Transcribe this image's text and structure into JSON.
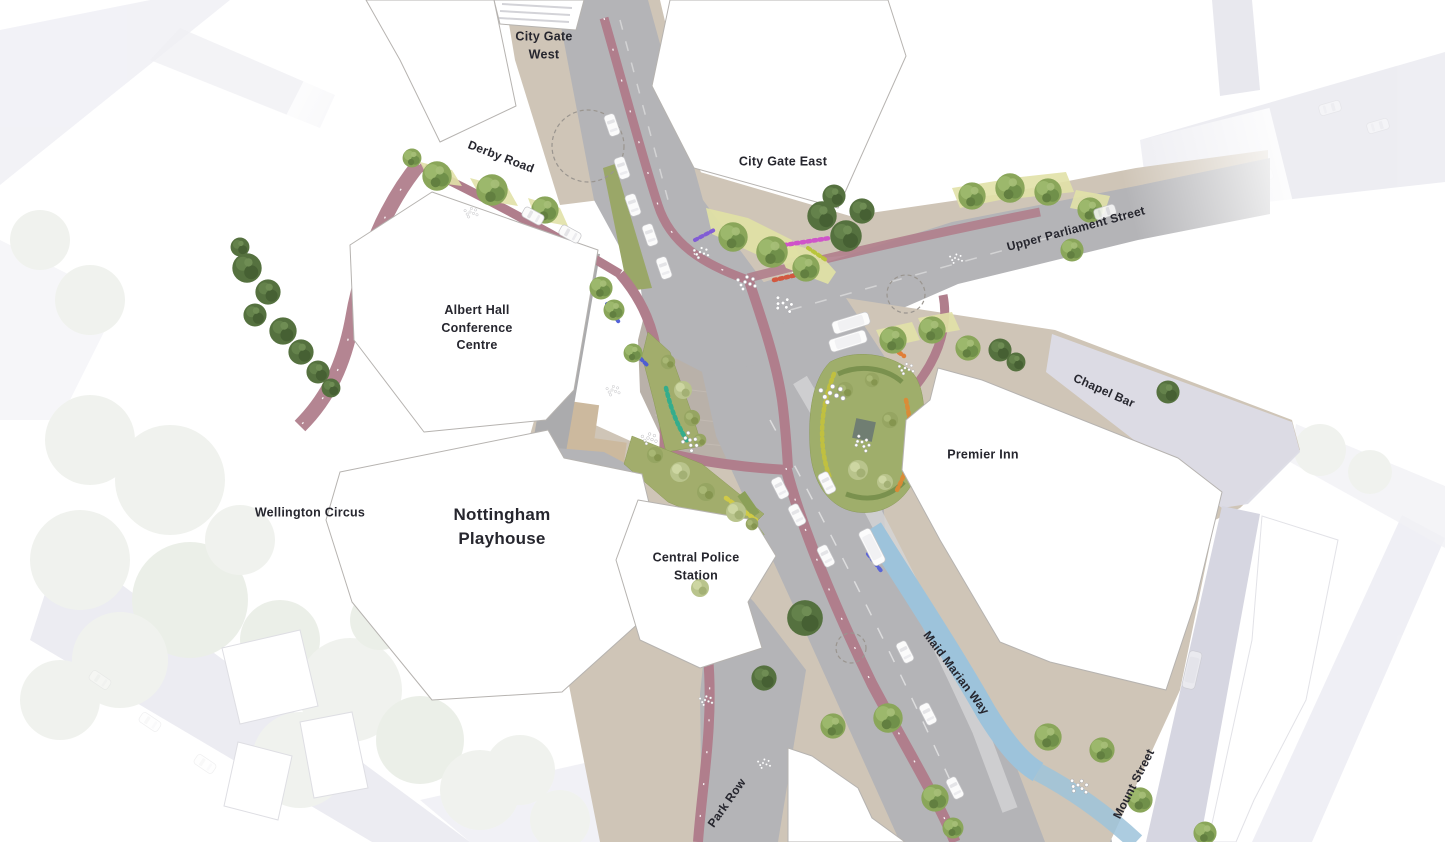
{
  "map": {
    "places": {
      "city_gate_west": "City Gate\nWest",
      "city_gate_east": "City Gate East",
      "albert_hall": "Albert Hall\nConference\nCentre",
      "premier_inn": "Premier Inn",
      "wellington_circus": "Wellington Circus",
      "nottingham_playhouse": "Nottingham\nPlayhouse",
      "central_police_station": "Central Police\nStation"
    },
    "streets": {
      "derby_road": "Derby Road",
      "upper_parliament_street": "Upper Parliament Street",
      "chapel_bar": "Chapel Bar",
      "maid_marian_way": "Maid Marian Way",
      "park_row": "Park Row",
      "mount_street": "Mount Street"
    },
    "palette": {
      "cycle_lane": "#b07e8c",
      "bus_lane": "#9cc2da",
      "road": "#b4b4b7",
      "paving": "#cfc5b7",
      "plaza": "#b9b1a9",
      "planting": "#a2ad6c",
      "tree_dark": "#55713f",
      "ghost": "#e2e2eb",
      "label_text": "#26262e"
    }
  }
}
